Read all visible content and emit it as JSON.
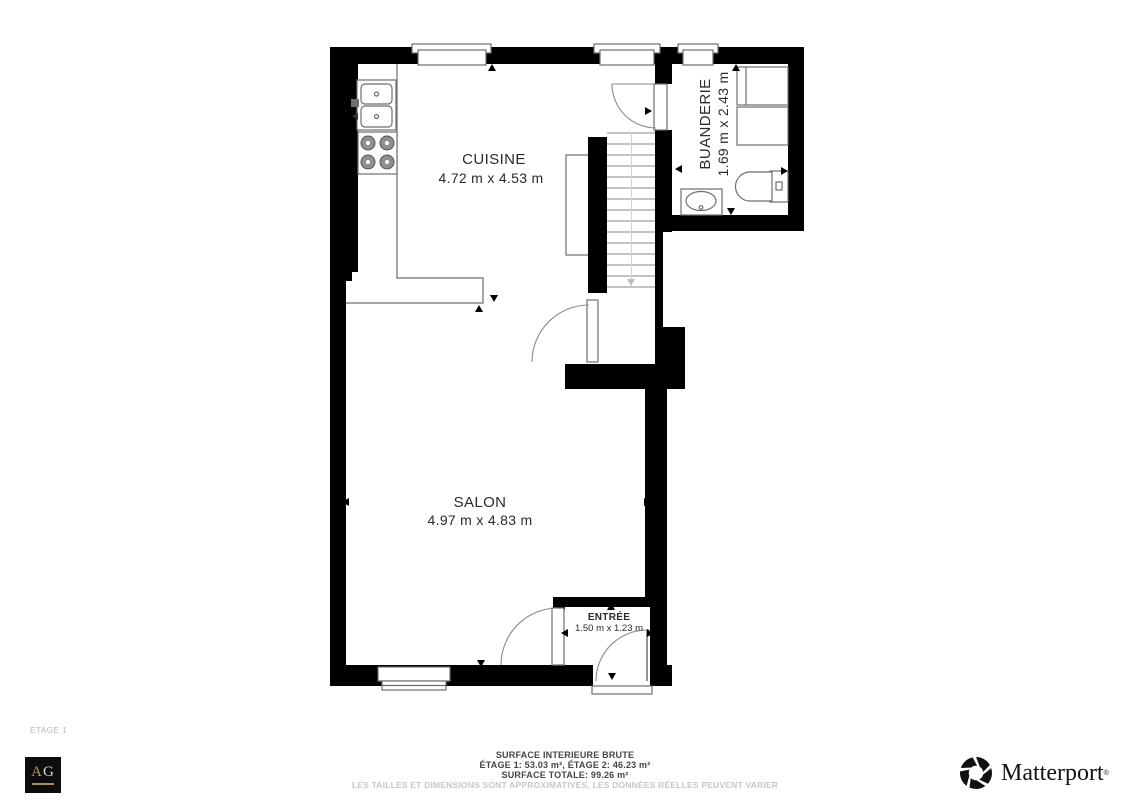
{
  "floorplan": {
    "rooms": {
      "cuisine": {
        "name": "CUISINE",
        "dims": "4.72 m x 4.53 m"
      },
      "salon": {
        "name": "SALON",
        "dims": "4.97 m x 4.83 m"
      },
      "buanderie": {
        "name": "BUANDERIE",
        "dims": "1.69 m x 2.43 m"
      },
      "entree": {
        "name": "ENTRÉE",
        "dims": "1.50 m x 1.23 m"
      }
    },
    "colors": {
      "wall": "#000000",
      "fixture_line": "#6e6e6e",
      "label_text": "#2b2b2b",
      "gold": "#b3945f"
    }
  },
  "floor_label": "ÉTAGE 1",
  "footer": {
    "line1": "SURFACE INTERIEURE BRUTE",
    "line2": "ÉTAGE 1: 53.03 m², ÉTAGE 2: 46.23 m²",
    "line3": "SURFACE TOTALE: 99.26 m²",
    "disclaimer": "LES TAILLES ET DIMENSIONS SONT APPROXIMATIVES, LES DONNÉES RÉELLES PEUVENT VARIER"
  },
  "branding": {
    "agency_letter_a": "A",
    "agency_letter_g": "G",
    "matterport_name": "Matterport",
    "matterport_mark": "®"
  }
}
